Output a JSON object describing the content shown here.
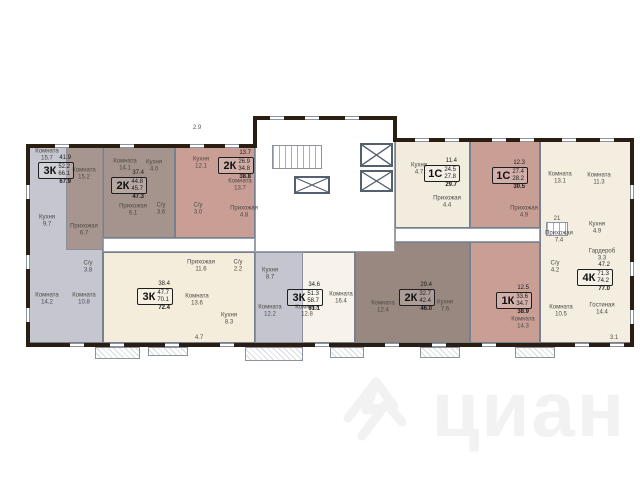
{
  "watermark": {
    "text": "циан"
  },
  "palette": {
    "exterior_wall": "#2a1d12",
    "interior_wall": "#77808f",
    "gray_apartment": "#c6c6d0",
    "taupe_apartment": "#a5948d",
    "pink_apartment": "#c99e95",
    "cream_apartment": "#f2ecdf"
  },
  "plan": {
    "apartments": [
      {
        "id": "apt-3k-left",
        "type": "3К",
        "areas": [
          "41.9",
          "52.2",
          "66.1",
          "67.9"
        ],
        "fill": "#c6c6d0",
        "x": 28,
        "y": 146,
        "w": 75,
        "h": 197,
        "label": {
          "x": 38,
          "y": 155
        }
      },
      {
        "id": "apt-2k-topleft",
        "type": "2К",
        "areas": [
          "37.4",
          "44.8",
          "45.7",
          "47.3"
        ],
        "fill": "#a5948d",
        "x": 103,
        "y": 146,
        "w": 72,
        "h": 92,
        "label": {
          "x": 111,
          "y": 170
        }
      },
      {
        "id": "apt-2k-topmid",
        "type": "2К",
        "areas": [
          "13.7",
          "26.9",
          "34.8",
          "38.8"
        ],
        "fill": "#c99e95",
        "x": 175,
        "y": 146,
        "w": 80,
        "h": 92,
        "label": {
          "x": 218,
          "y": 150
        }
      },
      {
        "id": "apt-1s-1",
        "type": "1С",
        "areas": [
          "11.4",
          "24.5",
          "27.8",
          "29.7"
        ],
        "fill": "#f2ecdf",
        "x": 395,
        "y": 140,
        "w": 75,
        "h": 88,
        "label": {
          "x": 424,
          "y": 158
        }
      },
      {
        "id": "apt-1s-2",
        "type": "1С",
        "areas": [
          "12.3",
          "27.4",
          "28.2",
          "30.5"
        ],
        "fill": "#c99e95",
        "x": 470,
        "y": 140,
        "w": 70,
        "h": 88,
        "label": {
          "x": 492,
          "y": 160
        }
      },
      {
        "id": "apt-4k",
        "type": "4К",
        "areas": [
          "47.2",
          "71.3",
          "74.2",
          "77.0"
        ],
        "fill": "#f4eee1",
        "x": 540,
        "y": 140,
        "w": 92,
        "h": 203,
        "label": {
          "x": 577,
          "y": 262
        }
      },
      {
        "id": "apt-3k-bottomleft",
        "type": "3К",
        "areas": [
          "38.4",
          "47.7",
          "70.1",
          "72.4"
        ],
        "fill": "#f5eddc",
        "x": 103,
        "y": 252,
        "w": 152,
        "h": 91,
        "label": {
          "x": 137,
          "y": 281
        }
      },
      {
        "id": "apt-3k-bottommid",
        "type": "3К",
        "areas": [
          "34.6",
          "51.3",
          "58.7",
          "61.1"
        ],
        "fill": "#f7f3ea",
        "x": 255,
        "y": 252,
        "w": 100,
        "h": 91,
        "label": {
          "x": 287,
          "y": 282
        }
      },
      {
        "id": "apt-2k-bottom",
        "type": "2К",
        "areas": [
          "29.4",
          "32.7",
          "42.4",
          "46.0"
        ],
        "fill": "#998880",
        "x": 355,
        "y": 242,
        "w": 115,
        "h": 101,
        "label": {
          "x": 399,
          "y": 282
        }
      },
      {
        "id": "apt-1k",
        "type": "1К",
        "areas": [
          "12.5",
          "33.6",
          "34.7",
          "38.9"
        ],
        "fill": "#c99e95",
        "x": 470,
        "y": 242,
        "w": 70,
        "h": 101,
        "label": {
          "x": 496,
          "y": 285
        }
      }
    ],
    "zones": [
      {
        "fill": "#a79690",
        "x": 66,
        "y": 146,
        "w": 37,
        "h": 104
      },
      {
        "fill": "#c4c5ce",
        "x": 255,
        "y": 252,
        "w": 48,
        "h": 91
      }
    ],
    "rooms": [
      {
        "n": "Комната",
        "a": "15.7",
        "x": 47,
        "y": 155
      },
      {
        "n": "Комната",
        "a": "15.2",
        "x": 84,
        "y": 174
      },
      {
        "n": "Кухня",
        "a": "9.7",
        "x": 47,
        "y": 221
      },
      {
        "n": "Прихожая",
        "a": "6.7",
        "x": 84,
        "y": 230
      },
      {
        "n": "С/у",
        "a": "3.8",
        "x": 88,
        "y": 267
      },
      {
        "n": "Комната",
        "a": "14.2",
        "x": 47,
        "y": 299
      },
      {
        "n": "Комната",
        "a": "10.8",
        "x": 84,
        "y": 299
      },
      {
        "n": "Комната",
        "a": "14.1",
        "x": 125,
        "y": 165
      },
      {
        "n": "Кухня",
        "a": "4.0",
        "x": 154,
        "y": 166
      },
      {
        "n": "Прихожая",
        "a": "6.1",
        "x": 133,
        "y": 210
      },
      {
        "n": "С/у",
        "a": "3.6",
        "x": 161,
        "y": 209
      },
      {
        "n": "Кухня",
        "a": "12.1",
        "x": 201,
        "y": 163
      },
      {
        "n": "Комната",
        "a": "13.7",
        "x": 240,
        "y": 185
      },
      {
        "n": "С/у",
        "a": "3.0",
        "x": 198,
        "y": 209
      },
      {
        "n": "Прихожая",
        "a": "4.8",
        "x": 244,
        "y": 212
      },
      {
        "n": "Кухня",
        "a": "4.7",
        "x": 419,
        "y": 169
      },
      {
        "n": "Прихожая",
        "a": "4.4",
        "x": 447,
        "y": 202
      },
      {
        "n": "Прихожая",
        "a": "4.9",
        "x": 524,
        "y": 212
      },
      {
        "n": "Комната",
        "a": "13.1",
        "x": 560,
        "y": 178
      },
      {
        "n": "Комната",
        "a": "11.3",
        "x": 599,
        "y": 179
      },
      {
        "n": "Кухня",
        "a": "4.9",
        "x": 597,
        "y": 228
      },
      {
        "n": "Прихожая",
        "a": "7.4",
        "x": 559,
        "y": 237
      },
      {
        "n": "Гардероб",
        "a": "3.3",
        "x": 602,
        "y": 255
      },
      {
        "n": "С/у",
        "a": "4.2",
        "x": 555,
        "y": 267
      },
      {
        "n": "Комната",
        "a": "10.5",
        "x": 561,
        "y": 311
      },
      {
        "n": "Гостиная",
        "a": "14.4",
        "x": 602,
        "y": 309
      },
      {
        "n": "Комната",
        "a": "14.3",
        "x": 523,
        "y": 323
      },
      {
        "n": "Кухня",
        "a": "7.6",
        "x": 445,
        "y": 306
      },
      {
        "n": "Комната",
        "a": "12.4",
        "x": 383,
        "y": 307
      },
      {
        "n": "Кухня",
        "a": "8.7",
        "x": 270,
        "y": 274
      },
      {
        "n": "Комната",
        "a": "12.2",
        "x": 270,
        "y": 311
      },
      {
        "n": "Комната",
        "a": "12.8",
        "x": 307,
        "y": 311
      },
      {
        "n": "Комната",
        "a": "16.4",
        "x": 341,
        "y": 298
      },
      {
        "n": "Прихожая",
        "a": "11.6",
        "x": 201,
        "y": 266
      },
      {
        "n": "С/у",
        "a": "2.2",
        "x": 238,
        "y": 266
      },
      {
        "n": "Комната",
        "a": "13.6",
        "x": 197,
        "y": 300
      },
      {
        "n": "Кухня",
        "a": "8.3",
        "x": 229,
        "y": 319
      }
    ],
    "dimension_labels": [
      {
        "t": "2.9",
        "x": 197,
        "y": 128
      },
      {
        "t": "4.7",
        "x": 199,
        "y": 338
      },
      {
        "t": "3.1",
        "x": 614,
        "y": 338
      },
      {
        "t": "21",
        "x": 557,
        "y": 219
      }
    ]
  }
}
